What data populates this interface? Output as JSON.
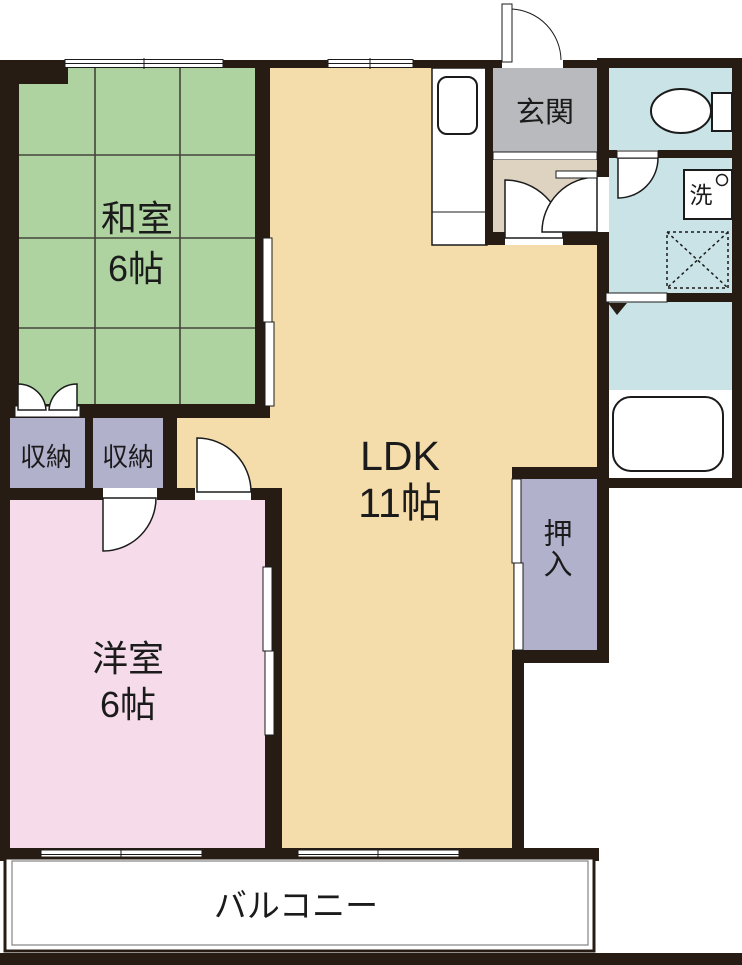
{
  "title": "apartment-floor-plan",
  "rooms": {
    "washitsu": {
      "name": "和室",
      "size": "6帖",
      "color": "#aed3a1"
    },
    "ldk": {
      "name": "LDK",
      "size": "11帖",
      "color": "#f4dcab"
    },
    "yoshitsu": {
      "name": "洋室",
      "size": "6帖",
      "color": "#f6dcea"
    },
    "genkan": {
      "name": "玄関",
      "color": "#b9babd"
    },
    "hall": {
      "color": "#ded3c0"
    },
    "shuno1": {
      "name": "収納",
      "color": "#b1b1cc"
    },
    "shuno2": {
      "name": "収納",
      "color": "#b1b1cc"
    },
    "oshiire": {
      "name": "押入",
      "color": "#b1b1cc"
    },
    "toilet": {
      "color": "#c9e3e6"
    },
    "washroom": {
      "color": "#c9e3e6"
    },
    "bathroom": {
      "color": "#c9e3e6"
    },
    "balcony": {
      "name": "バルコニー",
      "color": "#ffffff"
    }
  },
  "fixtures": {
    "washbasin_label": "洗"
  },
  "colors": {
    "wall": "#271c14",
    "text": "#1b1b1b",
    "tatami_grid": "#44443a",
    "background": "#ffffff"
  }
}
